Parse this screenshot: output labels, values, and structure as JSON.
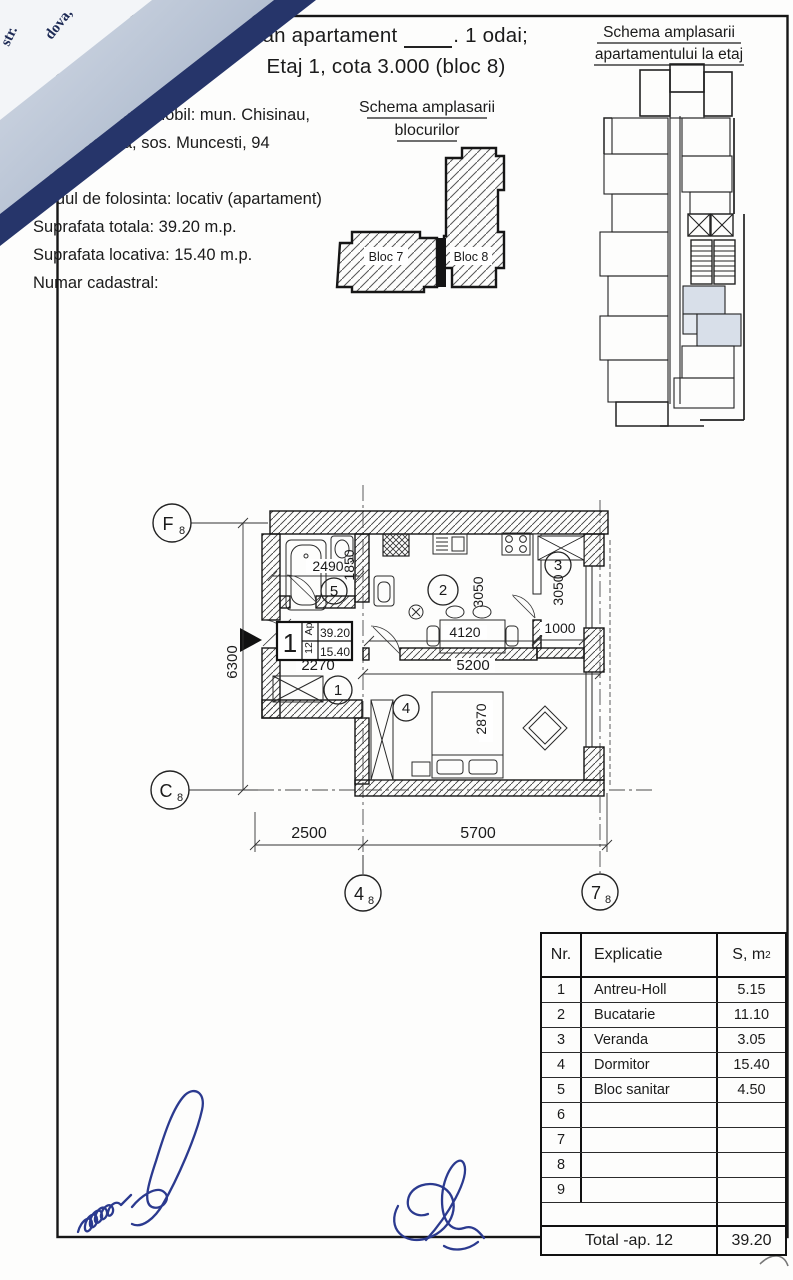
{
  "fold": {
    "text_a": "str.",
    "text_b": "dova,"
  },
  "header": {
    "line1_pre": "Plan apartament ",
    "line1_post": ". 1 odai;",
    "line2": "Etaj 1, cota 3.000 (bloc 8)"
  },
  "info": {
    "lines": [
      "Adresa bunului imobil: mun. Chisinau,",
      "sec. Botanica, sos. Muncesti, 94",
      "Bloc 8,",
      "Modul de folosinta: locativ (apartament)",
      "Suprafata totala: 39.20 m.p.",
      "Suprafata locativa: 15.40 m.p.",
      "Numar cadastral:"
    ]
  },
  "blocks_schema": {
    "title1": "Schema amplasarii",
    "title2": "blocurilor",
    "bloc7": "Bloc 7",
    "bloc8": "Bloc 8"
  },
  "floor_schema": {
    "title1": "Schema amplasarii",
    "title2": "apartamentului la etaj"
  },
  "plan": {
    "axes": {
      "f_main": "F",
      "f_sub": "8",
      "c_main": "C",
      "c_sub": "8",
      "n4_main": "4",
      "n4_sub": "8",
      "n7_main": "7",
      "n7_sub": "8"
    },
    "rooms": {
      "r1": "1",
      "r2": "2",
      "r3": "3",
      "r4": "4",
      "r5": "5"
    },
    "dims": {
      "w_bath": "2490",
      "h_bath": "1850",
      "w_kitchen": "4120",
      "h_kitchen": "3050",
      "h_veranda": "3050",
      "w_veranda": "1000",
      "w_hall": "2270",
      "w_kitchen_total": "5200",
      "h_bed": "2870",
      "h_total": "6300",
      "w_left": "2500",
      "w_right": "5700"
    },
    "apt_box": {
      "nr": "1",
      "ap": "Ap",
      "no": "12",
      "s1": "39.20",
      "s2": "15.40"
    }
  },
  "table": {
    "header": {
      "nr": "Nr.",
      "expl": "Explicatie",
      "s_main": "S, m",
      "s_sup": "2"
    },
    "rows": [
      {
        "nr": "1",
        "name": "Antreu-Holl",
        "s": "5.15"
      },
      {
        "nr": "2",
        "name": "Bucatarie",
        "s": "11.10"
      },
      {
        "nr": "3",
        "name": "Veranda",
        "s": "3.05"
      },
      {
        "nr": "4",
        "name": "Dormitor",
        "s": "15.40"
      },
      {
        "nr": "5",
        "name": "Bloc sanitar",
        "s": "4.50"
      },
      {
        "nr": "6",
        "name": "",
        "s": ""
      },
      {
        "nr": "7",
        "name": "",
        "s": ""
      },
      {
        "nr": "8",
        "name": "",
        "s": ""
      },
      {
        "nr": "9",
        "name": "",
        "s": ""
      }
    ],
    "total_label": "Total -ap. 12",
    "total_value": "39.20"
  }
}
